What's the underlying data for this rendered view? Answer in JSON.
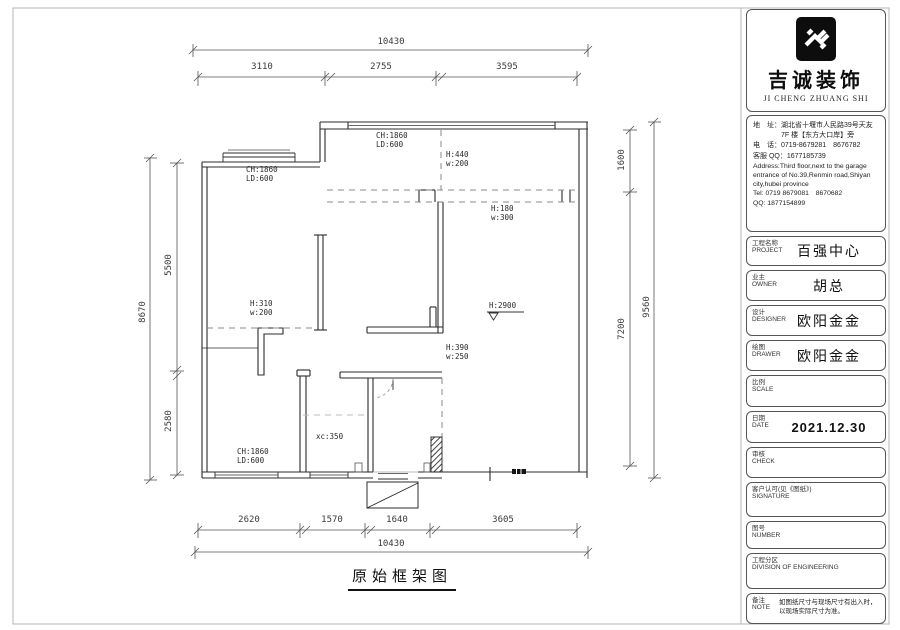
{
  "colors": {
    "ink": "#2b2b2b",
    "dashed": "#999999",
    "brand_black": "#111111"
  },
  "drawing": {
    "sheet_title": "原始框架图",
    "dims": {
      "top_total": "10430",
      "top_seg1": "3110",
      "top_seg2": "2755",
      "top_seg3": "3595",
      "bottom_seg1": "2620",
      "bottom_seg2": "1570",
      "bottom_seg3": "1640",
      "bottom_seg4": "3605",
      "bottom_total": "10430",
      "left_total": "8670",
      "left_seg1": "5500",
      "left_seg2": "2580",
      "right_total": "9560",
      "right_seg1": "1600",
      "right_seg2": "7200"
    },
    "annotations": {
      "win_top": {
        "l1": "CH:1860",
        "l2": "LD:600"
      },
      "win_left": {
        "l1": "CH:1860",
        "l2": "LD:600"
      },
      "beam_top": {
        "l1": "H:440",
        "l2": "w:200"
      },
      "beam_mid": {
        "l1": "H:180",
        "l2": "w:300"
      },
      "beam_left": {
        "l1": "H:310",
        "l2": "w:200"
      },
      "ceiling": {
        "l1": "H:2900"
      },
      "beam_low": {
        "l1": "H:390",
        "l2": "w:250"
      },
      "xc": {
        "l1": "xc:350"
      },
      "win_bottom": {
        "l1": "CH:1860",
        "l2": "LD:600"
      }
    }
  },
  "title_block": {
    "company_cn": "吉诚装饰",
    "company_en": "JI CHENG ZHUANG SHI",
    "contact": {
      "line1": "地　址：湖北省十堰市人民路39号天友",
      "line2": "　　　　7F 楼【东方大口岸】旁",
      "line3": "电　话：0719-8679281　8676782",
      "line4": "客服 QQ：1677185739",
      "line5": "Address:Third floor,next to the garage",
      "line6": "entrance of No.39,Renmin road,Shiyan",
      "line7": "city,hubei province",
      "line8": "Tel: 0719 8679081　8670682",
      "line9": "QQ: 1877154899"
    },
    "rows": [
      {
        "label_cn": "工程名称",
        "label_en": "PROJECT",
        "value": "百强中心"
      },
      {
        "label_cn": "业主",
        "label_en": "OWNER",
        "value": "胡总"
      },
      {
        "label_cn": "设计",
        "label_en": "DESIGNER",
        "value": "欧阳金金"
      },
      {
        "label_cn": "绘图",
        "label_en": "DRAWER",
        "value": "欧阳金金"
      },
      {
        "label_cn": "比例",
        "label_en": "SCALE",
        "value": ""
      },
      {
        "label_cn": "日期",
        "label_en": "DATE",
        "value": "2021.12.30"
      },
      {
        "label_cn": "审核",
        "label_en": "CHECK",
        "value": ""
      },
      {
        "label_cn": "客户认可(见《图纸》)",
        "label_en": "SIGNATURE",
        "value": ""
      },
      {
        "label_cn": "图号",
        "label_en": "NUMBER",
        "value": ""
      },
      {
        "label_cn": "工程分区",
        "label_en": "DIVISION OF ENGINEERING",
        "value": ""
      },
      {
        "label_cn": "备注",
        "label_en": "NOTE",
        "value": "如图纸尺寸与现场尺寸有出入时，以现场实际尺寸为准。"
      }
    ]
  }
}
